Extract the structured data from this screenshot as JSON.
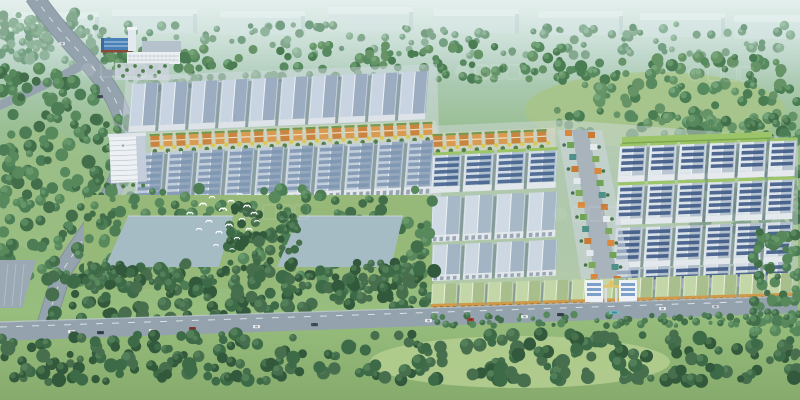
{
  "scene": {
    "size": {
      "w": 800,
      "h": 400
    },
    "background": {
      "stops": [
        [
          "0%",
          "#c8dfda"
        ],
        [
          "15%",
          "#b2cfc0"
        ],
        [
          "32%",
          "#9abf93"
        ],
        [
          "55%",
          "#90b77c"
        ],
        [
          "78%",
          "#98be7e"
        ],
        [
          "100%",
          "#86ab6c"
        ]
      ]
    },
    "haze": {
      "color": "#ffffff",
      "height": 85,
      "opacity": 0.5
    },
    "meadows": [
      {
        "cx": 655,
        "cy": 110,
        "rx": 130,
        "ry": 38,
        "fill": "#a6c489",
        "op": 0.9
      },
      {
        "cx": 520,
        "cy": 362,
        "rx": 150,
        "ry": 26,
        "fill": "#b2cd8f",
        "op": 0.9
      },
      {
        "cx": 150,
        "cy": 250,
        "rx": 95,
        "ry": 42,
        "fill": "#9cbb80",
        "op": 0.8
      },
      {
        "cx": 40,
        "cy": 190,
        "rx": 60,
        "ry": 60,
        "fill": "#9fbf85",
        "op": 0.6
      }
    ],
    "distant_buildings": {
      "w": 85,
      "h": 24,
      "fill": "#d8e7e7",
      "top": "#eaf4f3",
      "side": "#c2d5d7",
      "opacity": 0.5,
      "items": [
        [
          14,
          12
        ],
        [
          112,
          9
        ],
        [
          220,
          11
        ],
        [
          328,
          7
        ],
        [
          434,
          9
        ],
        [
          538,
          11
        ],
        [
          640,
          13
        ],
        [
          734,
          15
        ]
      ]
    },
    "forests": {
      "back": [
        {
          "x": 0,
          "y": 10,
          "w": 95,
          "h": 55,
          "n": 70,
          "rmin": 3,
          "rmax": 6,
          "c": "hazy"
        },
        {
          "x": 0,
          "y": 24,
          "w": 800,
          "h": 32,
          "n": 150,
          "rmin": 2.5,
          "rmax": 5,
          "c": "hazy"
        },
        {
          "x": 95,
          "y": 50,
          "w": 110,
          "h": 45,
          "n": 55,
          "rmin": 3,
          "rmax": 6,
          "c": "mid"
        },
        {
          "x": 200,
          "y": 44,
          "w": 365,
          "h": 36,
          "n": 95,
          "rmin": 3,
          "rmax": 5.5,
          "c": "mid"
        },
        {
          "x": 552,
          "y": 56,
          "w": 248,
          "h": 80,
          "n": 150,
          "rmin": 3,
          "rmax": 6.5,
          "c": "mid"
        },
        {
          "x": 688,
          "y": 118,
          "w": 112,
          "h": 120,
          "n": 130,
          "rmin": 3.5,
          "rmax": 7,
          "c": "mid2"
        }
      ],
      "sides": [
        {
          "x": 0,
          "y": 66,
          "w": 100,
          "h": 215,
          "n": 150,
          "rmin": 3.5,
          "rmax": 7,
          "c": "mid2"
        },
        {
          "x": 98,
          "y": 118,
          "w": 36,
          "h": 86,
          "n": 40,
          "rmin": 3,
          "rmax": 5.5,
          "c": "mid2"
        }
      ],
      "ponds_area": [
        {
          "x": 78,
          "y": 188,
          "w": 356,
          "h": 102,
          "n": 210,
          "rmin": 3,
          "rmax": 6.5,
          "c": "mid2"
        }
      ],
      "ponds_extra": [
        {
          "x": 228,
          "y": 206,
          "w": 72,
          "h": 62,
          "n": 55,
          "rmin": 3,
          "rmax": 6,
          "c": "dark"
        },
        {
          "x": 90,
          "y": 262,
          "w": 330,
          "h": 26,
          "n": 70,
          "rmin": 3,
          "rmax": 5.5,
          "c": "dark"
        }
      ],
      "mid": [
        {
          "x": 48,
          "y": 268,
          "w": 390,
          "h": 54,
          "n": 170,
          "rmin": 3.5,
          "rmax": 7,
          "c": "dark"
        }
      ],
      "road_edge": [
        {
          "x": 428,
          "y": 314,
          "w": 372,
          "h": 12,
          "n": 80,
          "rmin": 2,
          "rmax": 4,
          "c": "mid2"
        }
      ],
      "front": [
        {
          "x": 0,
          "y": 334,
          "w": 800,
          "h": 48,
          "n": 280,
          "rmin": 3.5,
          "rmax": 7.5,
          "c": "dark"
        },
        {
          "x": 752,
          "y": 232,
          "w": 48,
          "h": 100,
          "n": 70,
          "rmin": 3,
          "rmax": 6,
          "c": "mid2"
        }
      ]
    },
    "tree_palettes": {
      "hazy": {
        "c": [
          "#84a98f",
          "#76a084",
          "#90b59c"
        ],
        "l": [
          "#a3c5ae",
          "#96bba1"
        ]
      },
      "mid": {
        "c": [
          "#588a60",
          "#4b7d53",
          "#669467"
        ],
        "l": [
          "#7aa97e",
          "#6d9c72"
        ]
      },
      "mid2": {
        "c": [
          "#4c7d54",
          "#426f4a",
          "#57895c"
        ],
        "l": [
          "#6a9c6e",
          "#5f9164"
        ]
      },
      "dark": {
        "c": [
          "#3d6b47",
          "#32593b",
          "#476f4e"
        ],
        "l": [
          "#58855c",
          "#4c7850"
        ]
      }
    },
    "roads": {
      "highway": {
        "path": "M 34,-4 C 66,46 116,78 125,128 C 133,176 92,224 63,270 L 46,324",
        "width": 17,
        "fill": "#94a3ae",
        "casing": "#7e8d99",
        "dash": "#e8edf1"
      },
      "branch_left": {
        "path": "M 84,64 C 56,80 26,94 -2,106",
        "width": 9
      },
      "branch_factory": {
        "path": "M 102,72 C 120,74 138,72 158,68",
        "width": 6
      },
      "corner_lot": {
        "pts": [
          [
            0,
            260
          ],
          [
            36,
            260
          ],
          [
            22,
            308
          ],
          [
            0,
            308
          ]
        ],
        "fill": "#9aa9b3",
        "lines": "#c9d2d8"
      },
      "main": {
        "pts": [
          [
            0,
            322
          ],
          [
            798,
            296
          ],
          [
            798,
            313
          ],
          [
            0,
            341
          ]
        ],
        "fill": "#93a2ad",
        "edge": "#c6d0d8",
        "dash": "#eef2f5"
      }
    },
    "factory": {
      "shed": {
        "x": 142,
        "y": 41,
        "w": 39,
        "h": 12,
        "fill": "#b6c2cb"
      },
      "blue_building": {
        "x": 101,
        "y": 38,
        "w": 31,
        "h": 12,
        "roof": "#4a80b8",
        "ridge": "#dce8f4",
        "base": "#8a4a3a",
        "gable": "#3a699e"
      },
      "tower": {
        "x": 128,
        "y": 29,
        "w": 8,
        "h": 22,
        "fill": "#e3eaef",
        "cap": "#f0f4f6"
      },
      "office": {
        "x": 127,
        "y": 52,
        "w": 53,
        "h": 12,
        "fill": "#eaeff2",
        "lines": "#b3bfca"
      },
      "plaza": {
        "x": 115,
        "y": 63,
        "w": 54,
        "h": 17,
        "fill": "#c9d3d8",
        "tree": "#4e7d4c"
      }
    },
    "aprons": [
      {
        "pts": [
          [
            126,
            76
          ],
          [
            437,
            64
          ],
          [
            441,
            200
          ],
          [
            115,
            212
          ]
        ],
        "fill": "#d4dce3",
        "op": 0.5
      },
      {
        "pts": [
          [
            428,
            126
          ],
          [
            566,
            120
          ],
          [
            798,
            138
          ],
          [
            798,
            300
          ],
          [
            434,
            312
          ]
        ],
        "fill": "#d4dce3",
        "op": 0.45
      }
    ],
    "warehouse_rows": [
      {
        "name": "left-row-a",
        "x": 132,
        "y": 84,
        "rot": -2.5,
        "skew": -7,
        "count": 10,
        "w": 27,
        "gap": 3,
        "h": 42,
        "wallH": 6,
        "roofL": "#c8d4e1",
        "roofS": "#9cadc1",
        "ridge": "#eff3f8",
        "wall": "#dde3e9",
        "panels": false,
        "panelColor": "",
        "doors": false,
        "doorColor": "",
        "cap": ""
      },
      {
        "name": "left-row-b",
        "x": 138,
        "y": 153,
        "rot": -2.5,
        "skew": -7,
        "count": 10,
        "w": 27,
        "gap": 3,
        "h": 46,
        "wallH": 8,
        "roofL": "#c0cddb",
        "roofS": "#95a8bd",
        "ridge": "#edf2f7",
        "wall": "#e3e8ed",
        "panels": true,
        "panelColor": "#7e95b0",
        "doors": true,
        "doorColor": "#97a4b1",
        "cap": ""
      },
      {
        "name": "right-inner-top",
        "x": 433,
        "y": 155,
        "rot": -2.5,
        "skew": -6,
        "count": 4,
        "w": 29,
        "gap": 3,
        "h": 32,
        "wallH": 6,
        "roofL": "#d3dde6",
        "roofS": "#aebfcd",
        "ridge": "#f0f4f8",
        "wall": "#e2e7ec",
        "panels": true,
        "panelColor": "#41608c",
        "doors": false,
        "doorColor": "",
        "cap": "#9cc468"
      },
      {
        "name": "right-inner-mid",
        "x": 433,
        "y": 197,
        "rot": -2.5,
        "skew": -6,
        "count": 4,
        "w": 29,
        "gap": 3,
        "h": 38,
        "wallH": 7,
        "roofL": "#cfdae4",
        "roofS": "#a7b8c7",
        "ridge": "#eef3f7",
        "wall": "#e3e8ed",
        "panels": false,
        "panelColor": "",
        "doors": true,
        "doorColor": "#9aa7b4",
        "cap": ""
      },
      {
        "name": "right-inner-bottom",
        "x": 433,
        "y": 245,
        "rot": -2.5,
        "skew": -6,
        "count": 4,
        "w": 29,
        "gap": 3,
        "h": 30,
        "wallH": 6,
        "roofL": "#ccd7e1",
        "roofS": "#a3b4c4",
        "ridge": "#eef3f7",
        "wall": "#e2e7ec",
        "panels": false,
        "panelColor": "",
        "doors": true,
        "doorColor": "#9aa7b4",
        "cap": ""
      },
      {
        "name": "right-outer-a",
        "x": 620,
        "y": 146,
        "rot": -2,
        "skew": -6,
        "count": 6,
        "w": 27,
        "gap": 3,
        "h": 30,
        "wallH": 6,
        "roofL": "#dfe6ec",
        "roofS": "#b9c6d2",
        "ridge": "#f2f5f8",
        "wall": "#e6eaee",
        "panels": true,
        "panelColor": "#3a5684",
        "doors": false,
        "doorColor": "",
        "cap": "#9cc468"
      },
      {
        "name": "right-outer-b",
        "x": 618,
        "y": 185,
        "rot": -2,
        "skew": -6,
        "count": 6,
        "w": 27,
        "gap": 3,
        "h": 34,
        "wallH": 6,
        "roofL": "#dce4ea",
        "roofS": "#b5c2cf",
        "ridge": "#f0f4f7",
        "wall": "#e4e9ed",
        "panels": true,
        "panelColor": "#3a5684",
        "doors": false,
        "doorColor": "",
        "cap": "#9cc468"
      },
      {
        "name": "right-outer-c",
        "x": 616,
        "y": 228,
        "rot": -2,
        "skew": -6,
        "count": 6,
        "w": 27,
        "gap": 3,
        "h": 34,
        "wallH": 6,
        "roofL": "#d9e1e8",
        "roofS": "#b2bfcc",
        "ridge": "#eff3f6",
        "wall": "#e3e8ec",
        "panels": true,
        "panelColor": "#3a5684",
        "doors": false,
        "doorColor": "",
        "cap": ""
      },
      {
        "name": "right-outer-d",
        "x": 614,
        "y": 268,
        "rot": -2,
        "skew": -6,
        "count": 6,
        "w": 27,
        "gap": 3,
        "h": 18,
        "wallH": 5,
        "roofL": "#d6dee5",
        "roofS": "#afbcc9",
        "ridge": "#eef2f5",
        "wall": "#e2e7eb",
        "panels": true,
        "panelColor": "#3a5684",
        "doors": false,
        "doorColor": "",
        "cap": ""
      }
    ],
    "bottom_row": {
      "name": "roadside-row",
      "x": 432,
      "y": 284,
      "rot": -1.8,
      "skew": -5,
      "count": 13,
      "w": 26,
      "gap": 2,
      "h": 20,
      "wallH": 9,
      "roofL": "#c3d6a8",
      "roofS": "#a8bf8d",
      "ridge": "#e9f1da",
      "wall": "#d09a4b",
      "panels": false,
      "panelColor": "",
      "doors": true,
      "doorColor": "#8a5c28",
      "cap": ""
    },
    "orange_style": {
      "block1": "#c9853f",
      "block2": "#d99a52",
      "roof": "#6f9a50",
      "trim": "#f0ead8",
      "ytree": "#d9c94e",
      "gtree": "#4b7a45",
      "base": "#ded8c6"
    },
    "orange_strips": [
      {
        "x": 150,
        "y": 131,
        "rot": -2.5,
        "len": 286
      },
      {
        "x": 433,
        "y": 131,
        "rot": -2.5,
        "len": 122
      }
    ],
    "green_building": {
      "x": 622,
      "y": 137,
      "rot": -2,
      "w": 150,
      "h": 7,
      "fill": "#9cc468",
      "edge": "#7ba84e"
    },
    "office_tower": {
      "x": 109,
      "y": 137,
      "rot": -2.5,
      "w": 27,
      "sideW": 9,
      "h": 46,
      "body": "#edf1f4",
      "side": "#c3ceda",
      "lines": "#a9b6c4",
      "roof": "#dfe5ea",
      "tree": "#4e7d4c"
    },
    "spine": {
      "x": 572,
      "y": 130,
      "topW": 16,
      "dx": 30,
      "dy": 168,
      "road": "#a8b3bc",
      "apron": "#ccd5dc",
      "blocks": [
        "#d9893d",
        "#6fa457",
        "#4f9188",
        "#c97b35",
        "#e4e9ed",
        "#7ba85a"
      ],
      "tree": "#47734a",
      "steps": 15
    },
    "gate": {
      "x": 585,
      "y": 280,
      "bldg": "#eef2f6",
      "glass": "#6f97c2",
      "accent": "#e0c46a",
      "pylon": "#d8dde2"
    },
    "ponds": {
      "grass": {
        "x": 84,
        "y": 195,
        "w": 348,
        "h": 94,
        "fill": "#96b878"
      },
      "pads": [
        [
          [
            128,
            216
          ],
          [
            233,
            216
          ],
          [
            219,
            267
          ],
          [
            105,
            267
          ]
        ],
        [
          [
            299,
            216
          ],
          [
            403,
            216
          ],
          [
            391,
            267
          ],
          [
            277,
            267
          ]
        ]
      ],
      "fill": "#a6bcc5",
      "edge": "#d2dee2"
    },
    "cars": [
      [
        68,
        330,
        "#e9edef",
        7
      ],
      [
        97,
        331,
        "#39434d",
        7
      ],
      [
        149,
        329,
        "#e9edef",
        7
      ],
      [
        189,
        327,
        "#8d3730",
        7
      ],
      [
        253,
        325,
        "#e9edef",
        7
      ],
      [
        311,
        323,
        "#434f5a",
        7
      ],
      [
        425,
        319,
        "#e9edef",
        7
      ],
      [
        467,
        318,
        "#aa3a31",
        7
      ],
      [
        521,
        315,
        "#e9edef",
        7
      ],
      [
        557,
        313,
        "#39434d",
        7
      ],
      [
        609,
        311,
        "#67bcc9",
        11
      ],
      [
        659,
        307,
        "#e9edef",
        7
      ],
      [
        712,
        305,
        "#ced3d7",
        7
      ],
      [
        59,
        42,
        "#dfe4e8",
        6
      ],
      [
        97,
        95,
        "#434f5a",
        6
      ],
      [
        120,
        144,
        "#e9edef",
        6
      ]
    ],
    "birds": [
      [
        190,
        213,
        1
      ],
      [
        203,
        204,
        1.1
      ],
      [
        212,
        197,
        0.9
      ],
      [
        223,
        209,
        1.2
      ],
      [
        231,
        201,
        1
      ],
      [
        240,
        194,
        0.8
      ],
      [
        247,
        206,
        1.1
      ],
      [
        254,
        213,
        1
      ],
      [
        242,
        219,
        0.9
      ],
      [
        229,
        225,
        1.1
      ],
      [
        219,
        232,
        1
      ],
      [
        237,
        238,
        0.9
      ],
      [
        249,
        229,
        1
      ],
      [
        257,
        221,
        0.8
      ],
      [
        209,
        221,
        1
      ],
      [
        199,
        229,
        0.9
      ],
      [
        216,
        245,
        0.8
      ],
      [
        232,
        249,
        0.7
      ]
    ],
    "watermarks": [
      [
        88,
        70,
        0.11
      ],
      [
        462,
        72,
        0.11
      ],
      [
        695,
        74,
        0.11
      ],
      [
        250,
        212,
        0.08
      ],
      [
        560,
        214,
        0.08
      ]
    ],
    "watermark_color": "#ffffff"
  }
}
